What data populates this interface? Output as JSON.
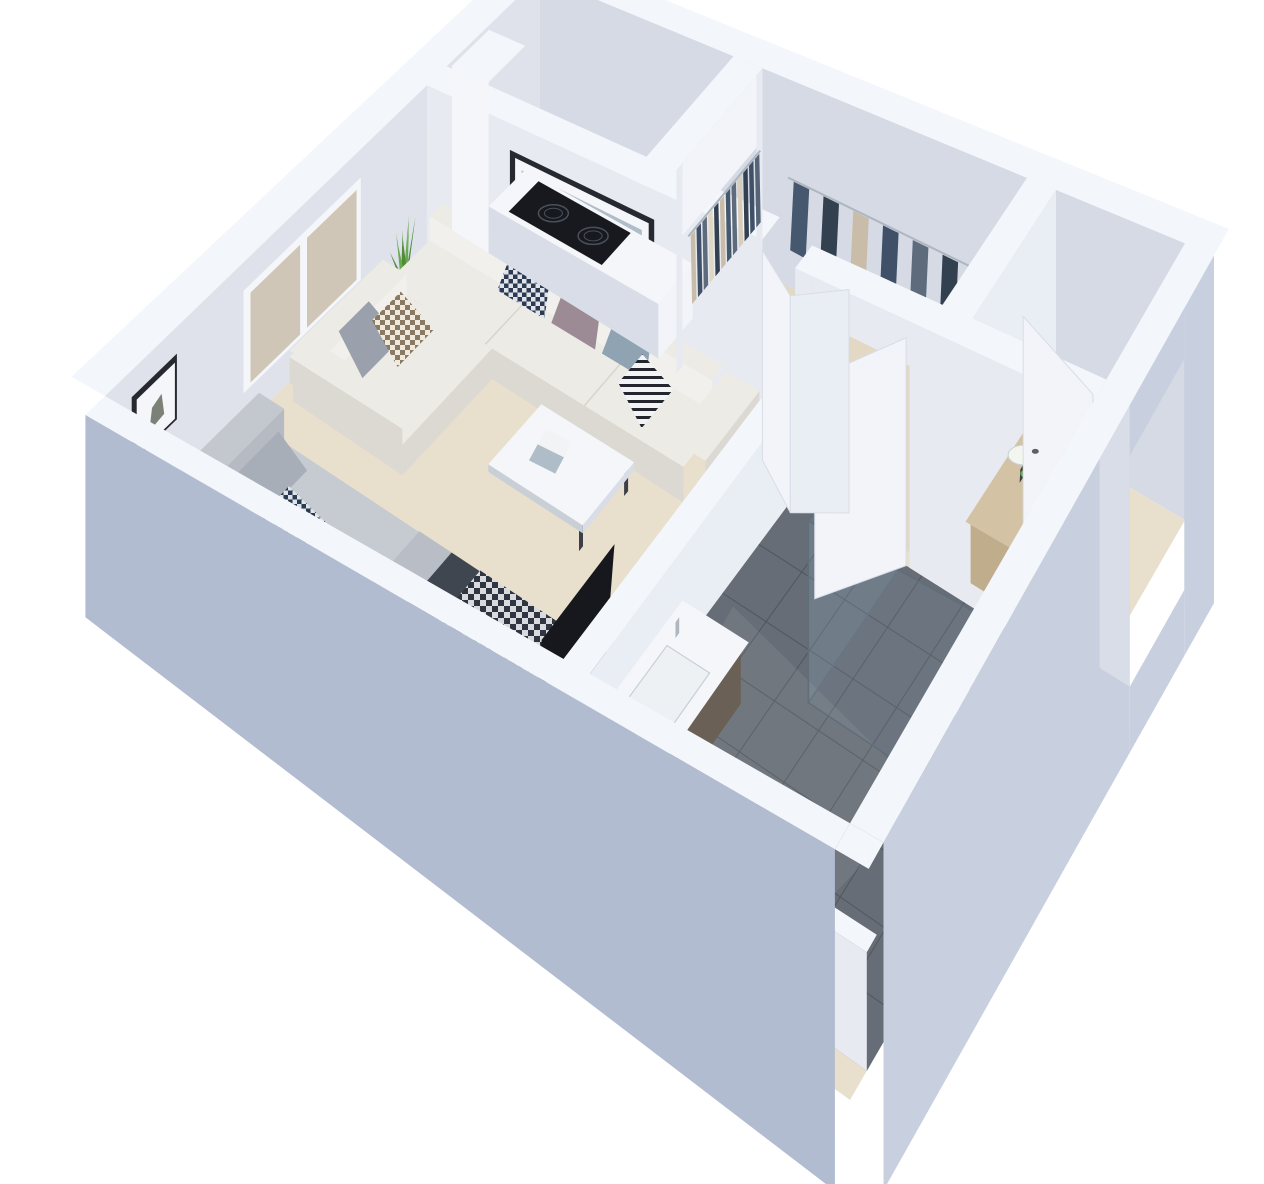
{
  "meta": {
    "description": "3D isometric cutaway render of a studio apartment floor plan",
    "view": "overhead axonometric dollhouse view, walls cut, white background",
    "background": "#ffffff"
  },
  "rooms": [
    {
      "name": "living-area",
      "furniture": [
        "l-shaped-sectional-sofa",
        "six-throw-pillows",
        "coffee-table-with-open-magazine",
        "framed-beach-artwork",
        "potted-snake-plant"
      ]
    },
    {
      "name": "sleeping-area",
      "furniture": [
        "double-bed",
        "upholstered-headboard",
        "gray-duvet",
        "dark-blanket",
        "houndstooth-throw",
        "framed-botanical-print",
        "tv-lowboard-with-flatscreen"
      ]
    },
    {
      "name": "kitchenette",
      "furniture": [
        "tall-white-cabinet",
        "white-counter",
        "two-burner-induction-cooktop",
        "bifold-door"
      ]
    },
    {
      "name": "walk-in-closet",
      "furniture": [
        "recessed-wardrobe-back-rail",
        "side-hanging-rail",
        "hanging-clothes"
      ]
    },
    {
      "name": "bathroom",
      "furniture": [
        "vanity-with-basin-and-faucet",
        "toilet",
        "walk-in-shower",
        "glass-partition",
        "floor-shower-head",
        "interior-door"
      ]
    },
    {
      "name": "entry-hall",
      "furniture": [
        "dresser-with-yellow-drawers",
        "vase-of-white-flowers",
        "entry-door"
      ]
    }
  ],
  "counts": {
    "window_panes": 2,
    "cooktop_burners": 2,
    "sofa_pillows": 6,
    "bed_pillows": 3,
    "door_leaves": 5,
    "closet_back_rail_items": 12,
    "closet_side_rail_items": 8,
    "plant_leaves": 9,
    "bathroom_tile_cols": 7,
    "bathroom_tile_rows": 7
  },
  "closet": {
    "back_row_colors": [
      "#c9bda9",
      "#3f5068",
      "#5d6b7d",
      "#e0d6c4",
      "#324050",
      "#c9bda9",
      "#46586e",
      "#5d6b7d",
      "#d8cdb9",
      "#324050",
      "#3f5068",
      "#556476"
    ],
    "side_row_colors": [
      "#46586e",
      "#324050",
      "#c9bda9",
      "#3f5068",
      "#5d6b7d",
      "#324050",
      "#d8cdb9",
      "#46586e"
    ]
  },
  "plant": {
    "leaf_count": 9,
    "leaf_colors": [
      "#4e8c39",
      "#69a851"
    ]
  },
  "bathroom": {
    "tile_cols": 7,
    "tile_rows": 7
  },
  "colors": {
    "wall_top": "#f3f6fb",
    "wall_int_nw": "#dfe2ea",
    "wall_int_ne": "#d5dae5",
    "partition_face": "#e7eaf1",
    "ext_sw": "#b2bcd0",
    "ext_se": "#c8d0df",
    "door_face": "#f2f4f9",
    "door_face2": "#e9edf4",
    "door_edge": "#d8dde7",
    "floor_main": "#e8dfcd",
    "floor_closet": "#e2d8c3",
    "bathroom_tile": "#676d76",
    "bathroom_tile_line": "#51565e",
    "tile_sheen": "rgba(255,255,255,0.07)",
    "white_fixture": "#f4f6f9",
    "fixture_shadow": "#c9cfd7",
    "basin_fill": "#eef1f4",
    "sofa_top": "#edebe6",
    "sofa_face": "#dcd9d2",
    "sofa_hi": "#f2f0ec",
    "sofa_seam": "#d8d5ce",
    "pillow_gray": "#a8aeb8",
    "pillow_gray2": "#9aa1ac",
    "mauve": "#9c8b94",
    "dusty_blue": "#8fa3b3",
    "bed_duvet": "#c6cad1",
    "bed_face": "#b2b7bf",
    "bed_side": "#a9aeb7",
    "bed_fold": "#b9bec6",
    "bed_dark": "#40464f",
    "headboard_face": "#b6bbc3",
    "headboard_top": "#c3c7ce",
    "check_a": "#2f3541",
    "check_b": "#d8dade",
    "navy_a": "#2c3a52",
    "navy_b": "#dfe3ea",
    "brown_a": "#8a7a63",
    "brown_b": "#f0e9dd",
    "stripe_a": "#23262c",
    "stripe_b": "#f2f3f5",
    "wood_light": "#d3c2a4",
    "wood_mid": "#c0ad8c",
    "vanity_wood": "#6a6055",
    "vanity_wood_dark": "#575046",
    "tv_black": "#16181d",
    "cooktop_black": "#17191e",
    "burner_ring": "#4a505a",
    "chrome": "#aeb6bf",
    "handle_dark": "#5a6068",
    "frame_dark": "#26292f",
    "art_sky": "#aebdc7",
    "art_sand": "#d3ccbd",
    "window_pane": "#cfc6b7",
    "planter_face": "#9ba1a9",
    "planter_side": "#878d95",
    "plant_green_dark": "#4e8c39",
    "plant_green_light": "#69a851",
    "yellow_drawer": "#e3b52c",
    "drawer_gray": "#c2c8d0",
    "drawer_white": "#f1f3f6",
    "glass_fill": "rgba(150,185,200,0.12)",
    "glass_stroke": "#5f6e7b",
    "flower_white": "#f3f5ef",
    "leg_dark": "#3c4046",
    "sketch_gray": "#7b8176"
  }
}
